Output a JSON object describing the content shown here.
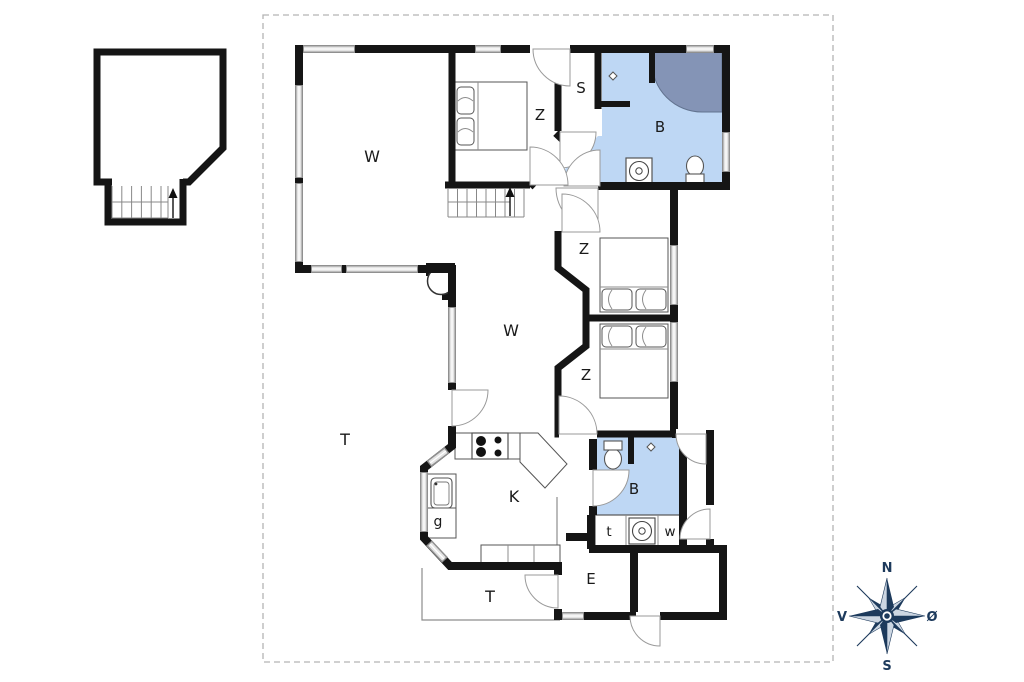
{
  "rooms": [
    {
      "id": "living-room",
      "label": "W"
    },
    {
      "id": "bedroom-top",
      "label": "Z"
    },
    {
      "id": "room-s",
      "label": "S"
    },
    {
      "id": "bathroom-main",
      "label": "B"
    },
    {
      "id": "bedroom-middle",
      "label": "Z"
    },
    {
      "id": "living-area-2",
      "label": "W"
    },
    {
      "id": "bedroom-lower",
      "label": "Z"
    },
    {
      "id": "terrace-west",
      "label": "T"
    },
    {
      "id": "kitchen",
      "label": "K"
    },
    {
      "id": "room-g",
      "label": "g"
    },
    {
      "id": "bathroom-2",
      "label": "B"
    },
    {
      "id": "room-t",
      "label": "t"
    },
    {
      "id": "room-w",
      "label": "w"
    },
    {
      "id": "entry",
      "label": "E"
    },
    {
      "id": "terrace-south",
      "label": "T"
    }
  ],
  "compass": {
    "north": "N",
    "east": "Ø",
    "south": "S",
    "west": "V"
  },
  "fixtures": [
    "bed-icon",
    "stove-icon",
    "sink-icon",
    "washing-machine-icon",
    "toilet-icon",
    "shower-icon",
    "fireplace-icon",
    "stairs-up-arrow-icon",
    "floor-drain-icon",
    "compass-rose-icon"
  ],
  "colors": {
    "wall": "#151515",
    "bathroom_fill": "#bed7f4",
    "shower_fill": "#8494b6",
    "window_fill": "#e3e3e3",
    "window_border": "#909090",
    "door_arc": "#9a9a9a",
    "compass_dark": "#1d3a5c",
    "compass_light": "#ccd6e2",
    "dashed_border": "#b3b3b3"
  }
}
